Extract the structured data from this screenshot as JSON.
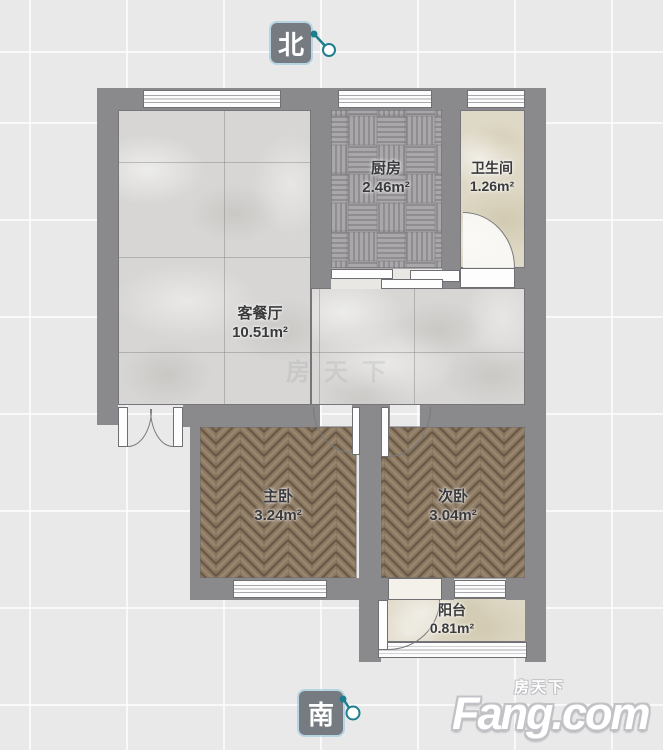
{
  "compass": {
    "north_label": "北",
    "south_label": "南"
  },
  "rooms": [
    {
      "name": "客餐厅",
      "area": "10.51m²"
    },
    {
      "name": "厨房",
      "area": "2.46m²"
    },
    {
      "name": "卫生间",
      "area": "1.26m²"
    },
    {
      "name": "主卧",
      "area": "3.24m²"
    },
    {
      "name": "次卧",
      "area": "3.04m²"
    },
    {
      "name": "阳台",
      "area": "0.81m²"
    }
  ],
  "branding": {
    "logo_text": "Fang.com",
    "logo_cn": "房天下",
    "watermark": "房天下"
  },
  "colors": {
    "wall": "#8a8a8c",
    "background": "#e9e9ea",
    "living_floor": "#d7d6d4",
    "kitchen_floor": "#a7a5a7",
    "wood_floor": "#8e7b64",
    "bath_floor": "#ded8c6",
    "compass_box": "#767b81",
    "compass_needle_teal": "#1f7e8e",
    "label_text": "#3a3a3c",
    "logo_color": "#ffffff"
  }
}
